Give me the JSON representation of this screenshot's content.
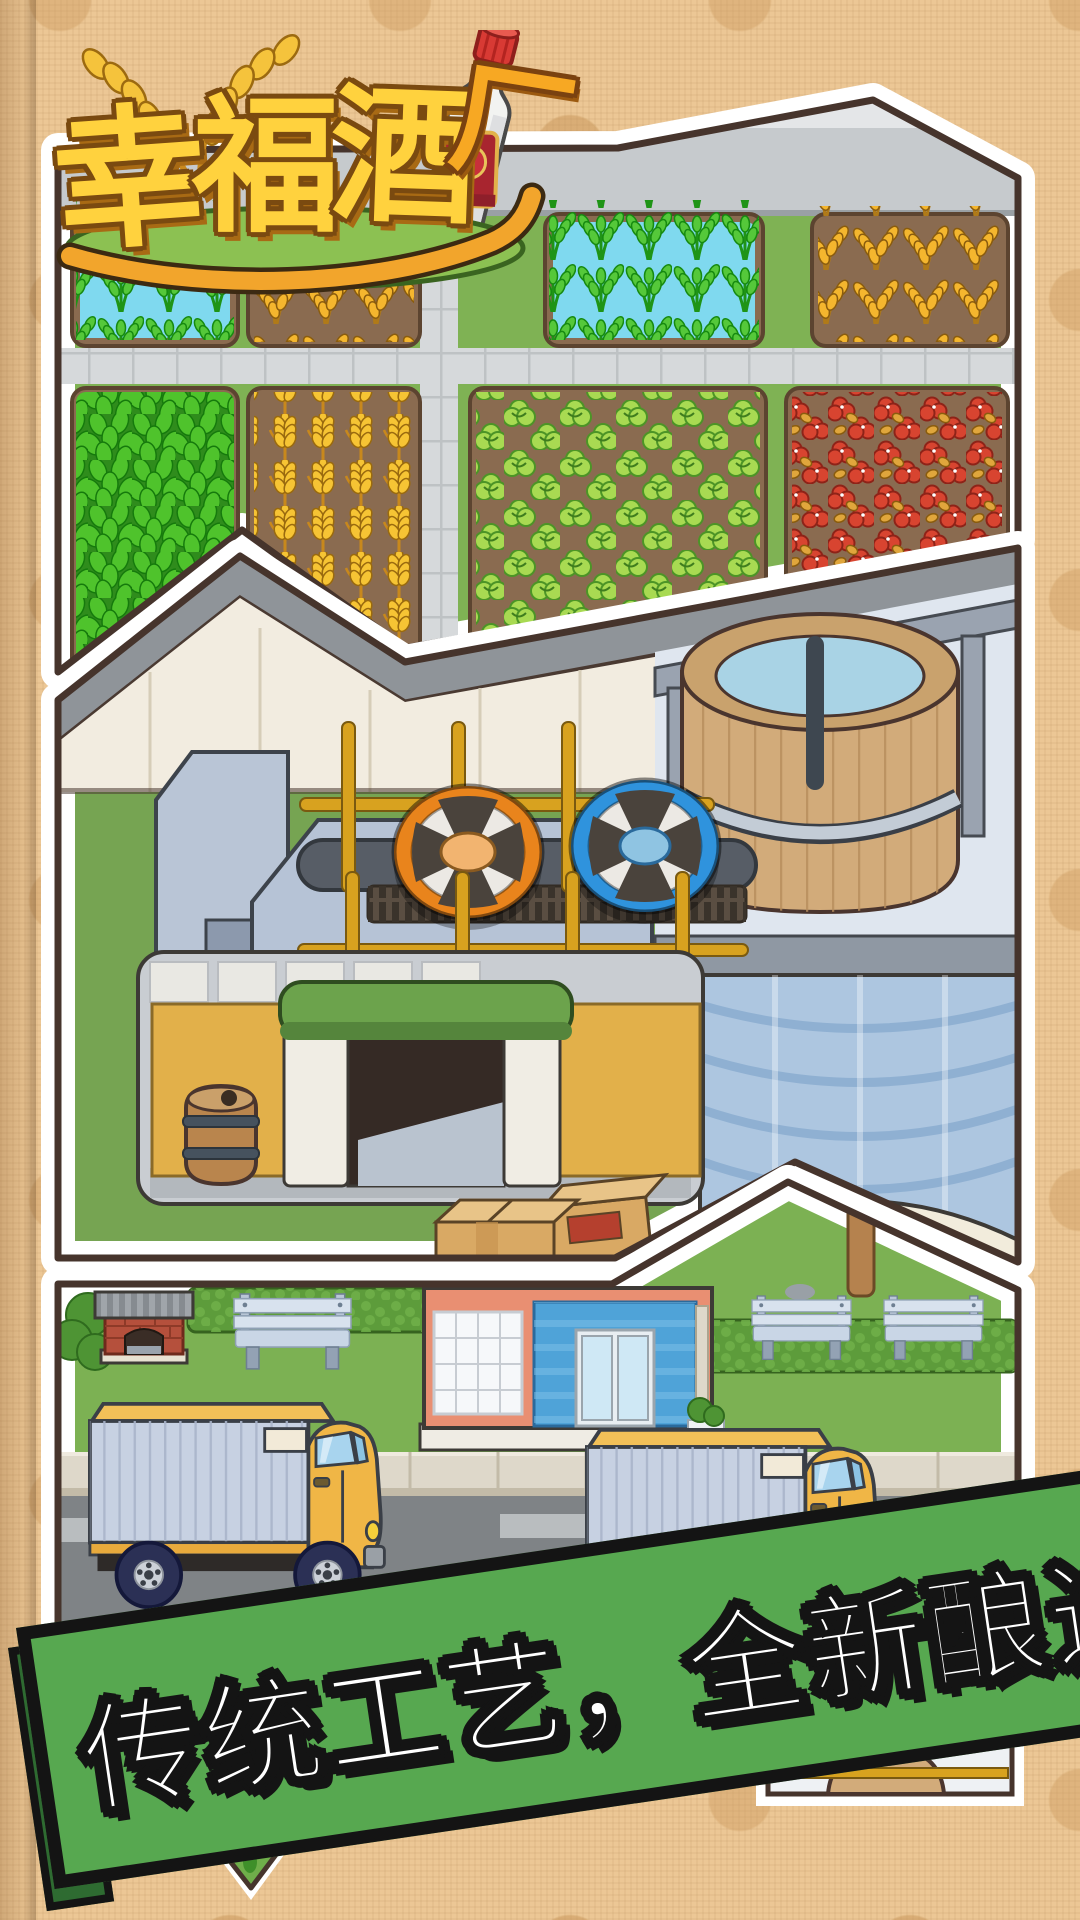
{
  "logo": {
    "title": "幸福酒厂",
    "chars": [
      "幸",
      "福",
      "酒",
      "厂"
    ]
  },
  "banner": {
    "text": "传统工艺，全新酿造",
    "bg_color": "#57a850",
    "border_color": "#141414",
    "text_color": "#ffffff"
  },
  "panels": {
    "farm": {
      "name": "farm-field-scene",
      "crops": [
        "rice-paddy",
        "golden-rice",
        "leafy-greens",
        "wheat",
        "lettuce",
        "chili-peppers"
      ]
    },
    "factory": {
      "name": "distillery-interior-scene",
      "props": [
        "grinder-fans",
        "gold-pipes",
        "fermentation-vat",
        "warehouse",
        "barrel",
        "cardboard-boxes"
      ]
    },
    "street": {
      "name": "delivery-street-scene",
      "props": [
        "dog-house",
        "benches",
        "storefront",
        "hedges",
        "delivery-trucks",
        "road"
      ]
    }
  },
  "colors": {
    "background": "#ecc795",
    "background_dots": "#c69458",
    "panel_border": "#ffffff",
    "panel_outline": "#46342c",
    "banner_green": "#57a850",
    "logo_gold": "#ffd23e",
    "logo_orange": "#f7a823",
    "bottle_cap_red": "#d83a34"
  }
}
